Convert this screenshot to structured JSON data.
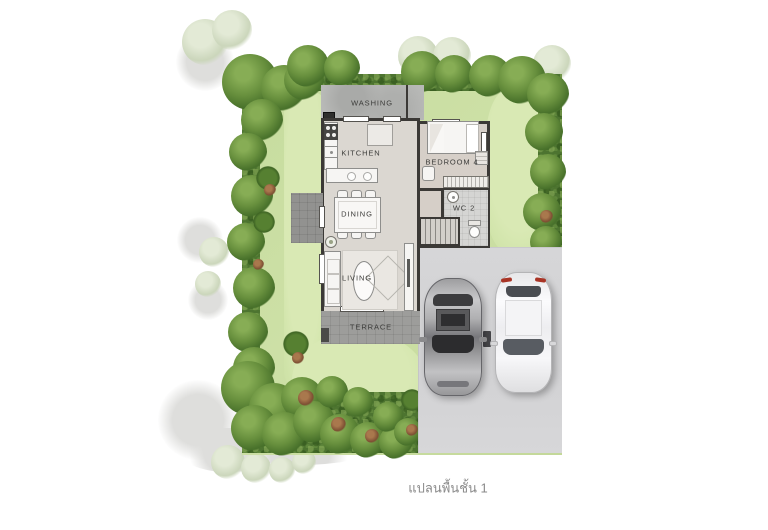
{
  "title": "แปลนพื้นชั้น 1",
  "caption": "แปลนพื้นชั้น 1",
  "rooms": {
    "washing": "WASHING",
    "kitchen": "KITCHEN",
    "bedroom4": "BEDROOM 4",
    "wc2": "WC 2",
    "dining": "DINING",
    "living": "LIVING",
    "terrace": "TERRACE"
  },
  "palette": {
    "hedge_green": "#4d7430",
    "lawn_green": "#c9dea1",
    "driveway_gray": "#d3d3d5",
    "wall_dark": "#3b3936",
    "floor_light": "#dbd7d1",
    "terrace_gray": "#9d9d9b",
    "washing_gray": "#b8b9b7",
    "label_color": "#3c3c3a",
    "caption_color": "#8a8a8a",
    "car_gray": "#9a9a9c",
    "car_white": "#f2f2f4",
    "taillight_red": "#a93425"
  }
}
